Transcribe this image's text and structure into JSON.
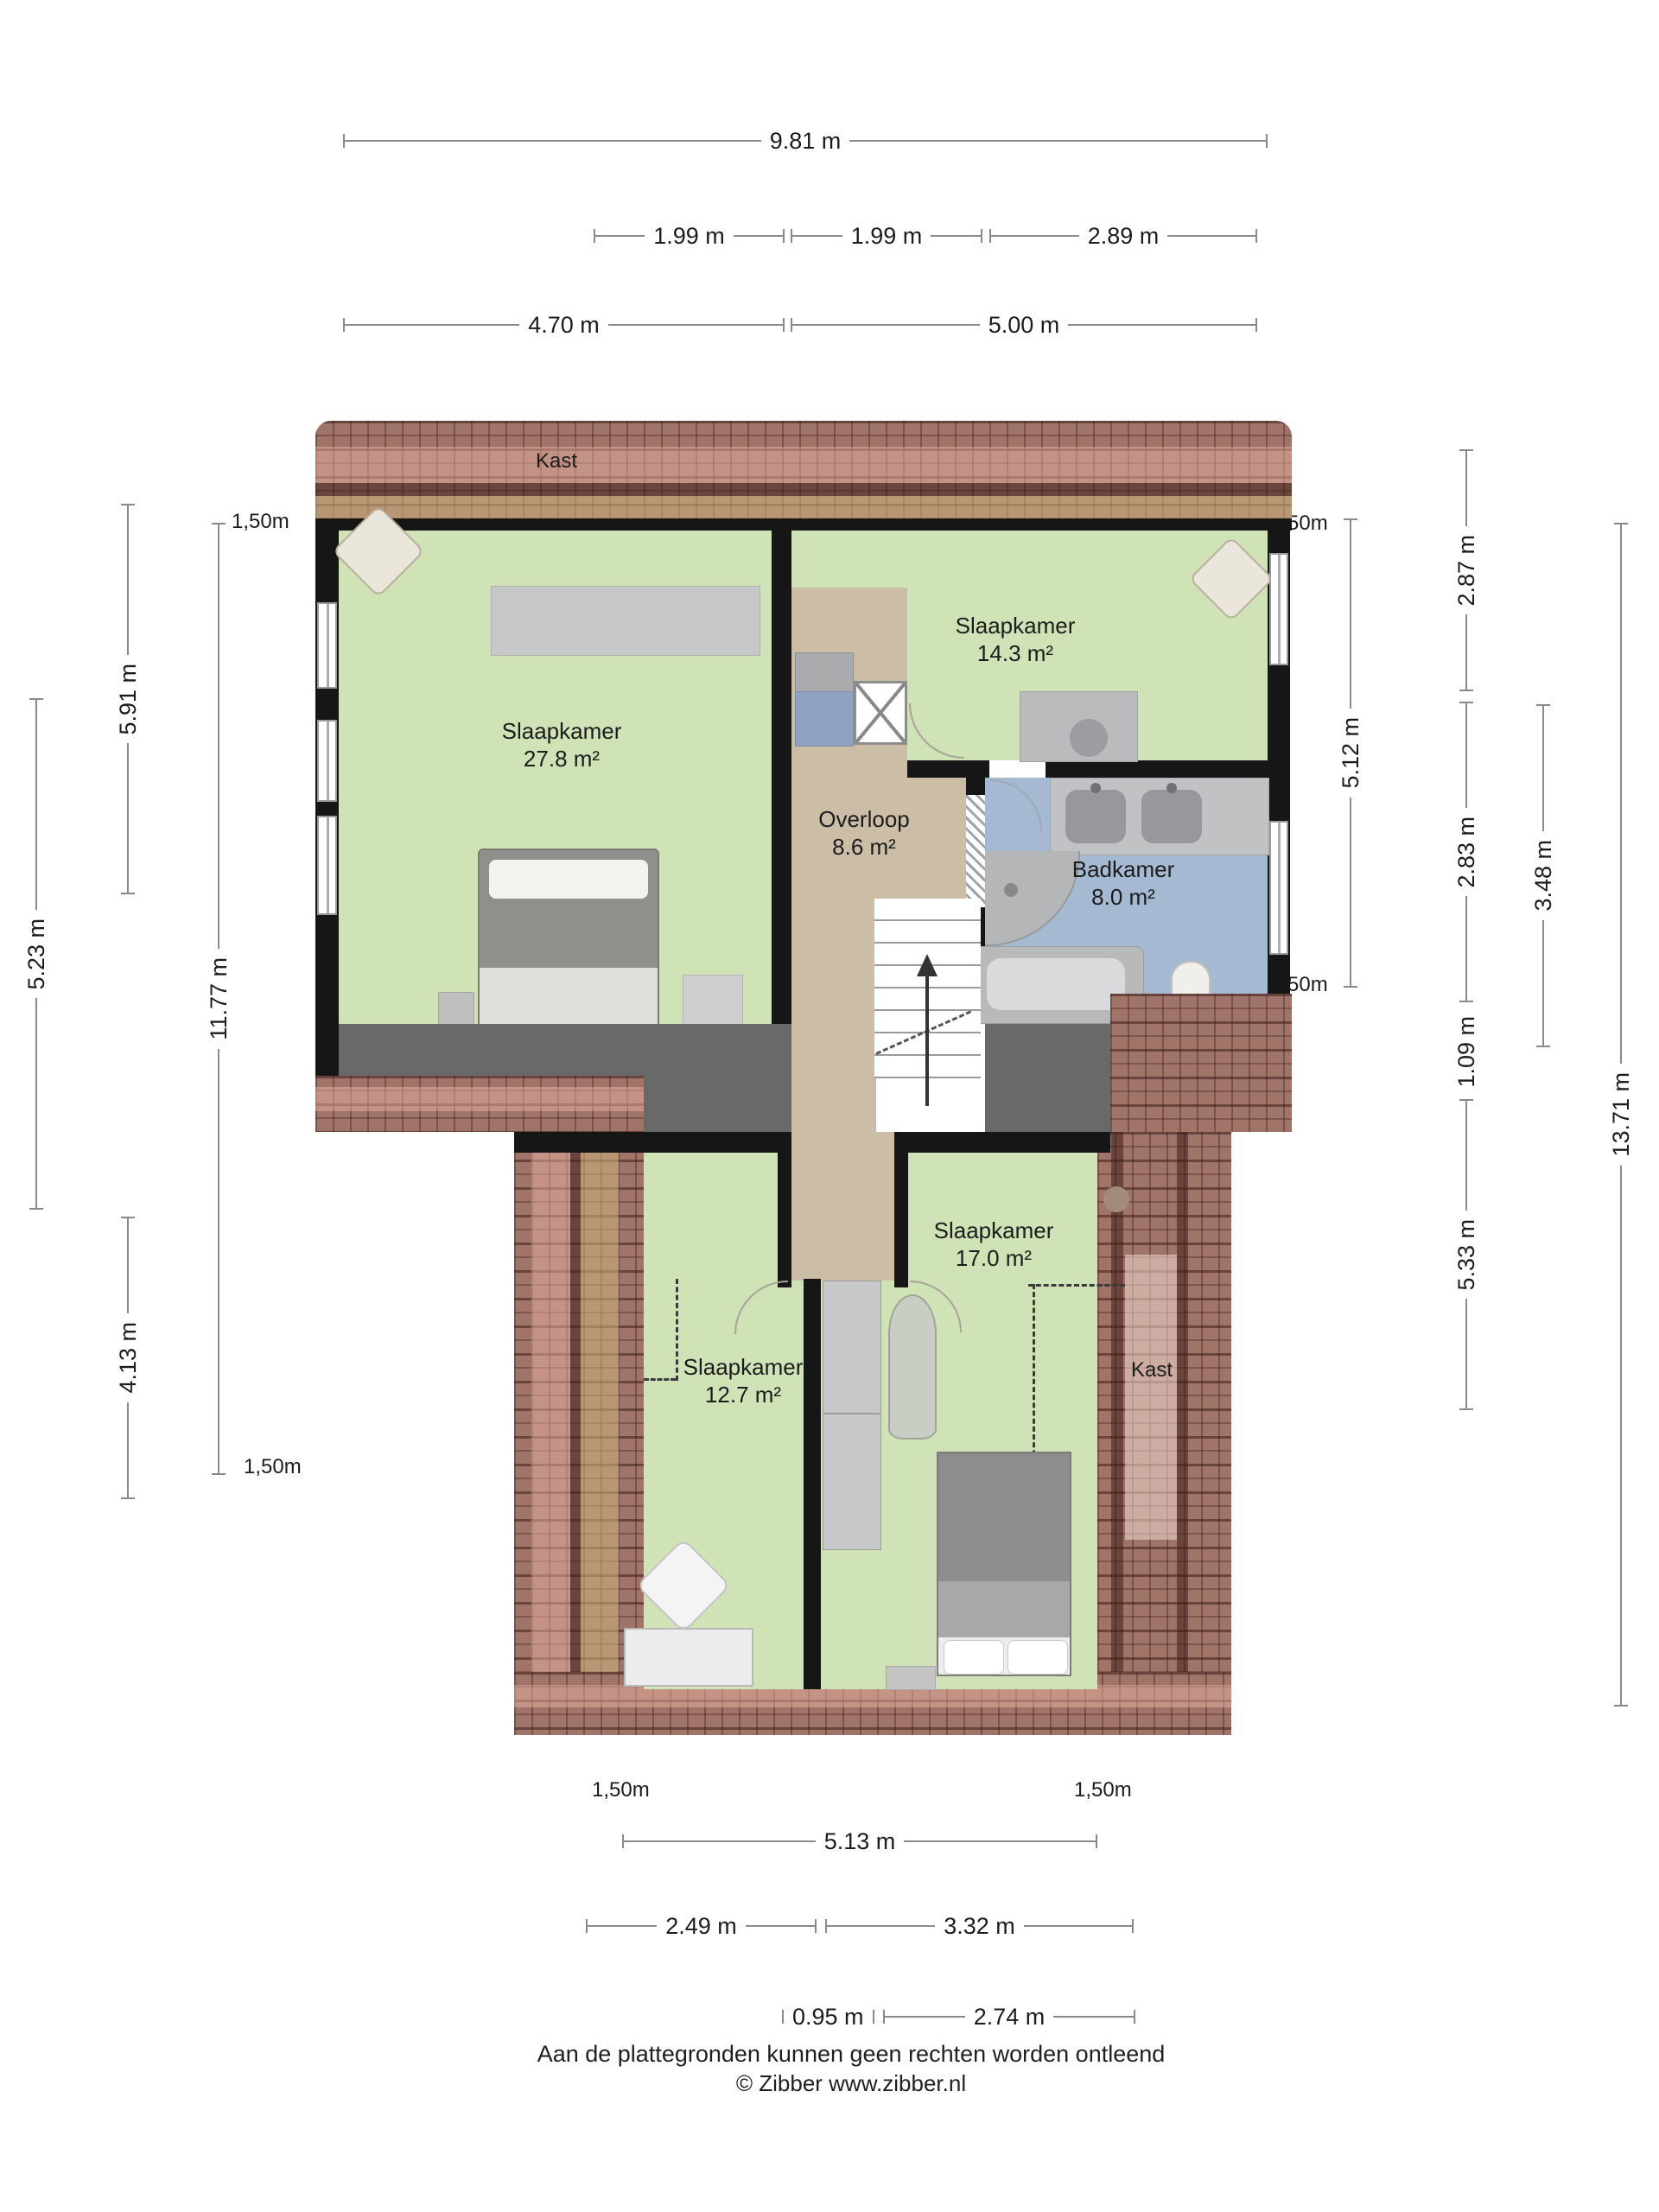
{
  "plan": {
    "clearance": "1,50m",
    "rooms": {
      "bedroom_large": {
        "name": "Slaapkamer",
        "area": "27.8 m²"
      },
      "bedroom_top_right": {
        "name": "Slaapkamer",
        "area": "14.3 m²"
      },
      "landing": {
        "name": "Overloop",
        "area": "8.6 m²"
      },
      "bathroom": {
        "name": "Badkamer",
        "area": "8.0 m²"
      },
      "bedroom_bottom_right": {
        "name": "Slaapkamer",
        "area": "17.0 m²"
      },
      "bedroom_bottom_left": {
        "name": "Slaapkamer",
        "area": "12.7 m²"
      },
      "closet_top": {
        "name": "Kast"
      },
      "closet_right": {
        "name": "Kast"
      }
    },
    "dims": {
      "top_total": "9.81 m",
      "top_row2": [
        "1.99 m",
        "1.99 m",
        "2.89 m"
      ],
      "top_row3": [
        "4.70 m",
        "5.00 m"
      ],
      "left": [
        "5.91 m",
        "5.23 m",
        "11.77 m",
        "4.13 m"
      ],
      "right": [
        "5.12 m",
        "2.87 m",
        "2.83 m",
        "1.09 m",
        "3.48 m",
        "5.33 m",
        "13.71 m"
      ],
      "bottom": [
        "5.13 m",
        "2.49 m",
        "3.32 m",
        "0.95 m",
        "2.74 m"
      ]
    }
  },
  "footer": {
    "disclaimer": "Aan de plattegronden kunnen geen rechten worden ontleend",
    "copyright": "© Zibber www.zibber.nl"
  },
  "colors": {
    "room_green": "#cfe3b6",
    "landing_tan": "#cbbda6",
    "bathroom_blue": "#a5bad2",
    "wall_black": "#161616",
    "roof_base": "#a1746a",
    "dead_space_gray": "#696969",
    "dimension_line_gray": "#8a8a8a"
  }
}
